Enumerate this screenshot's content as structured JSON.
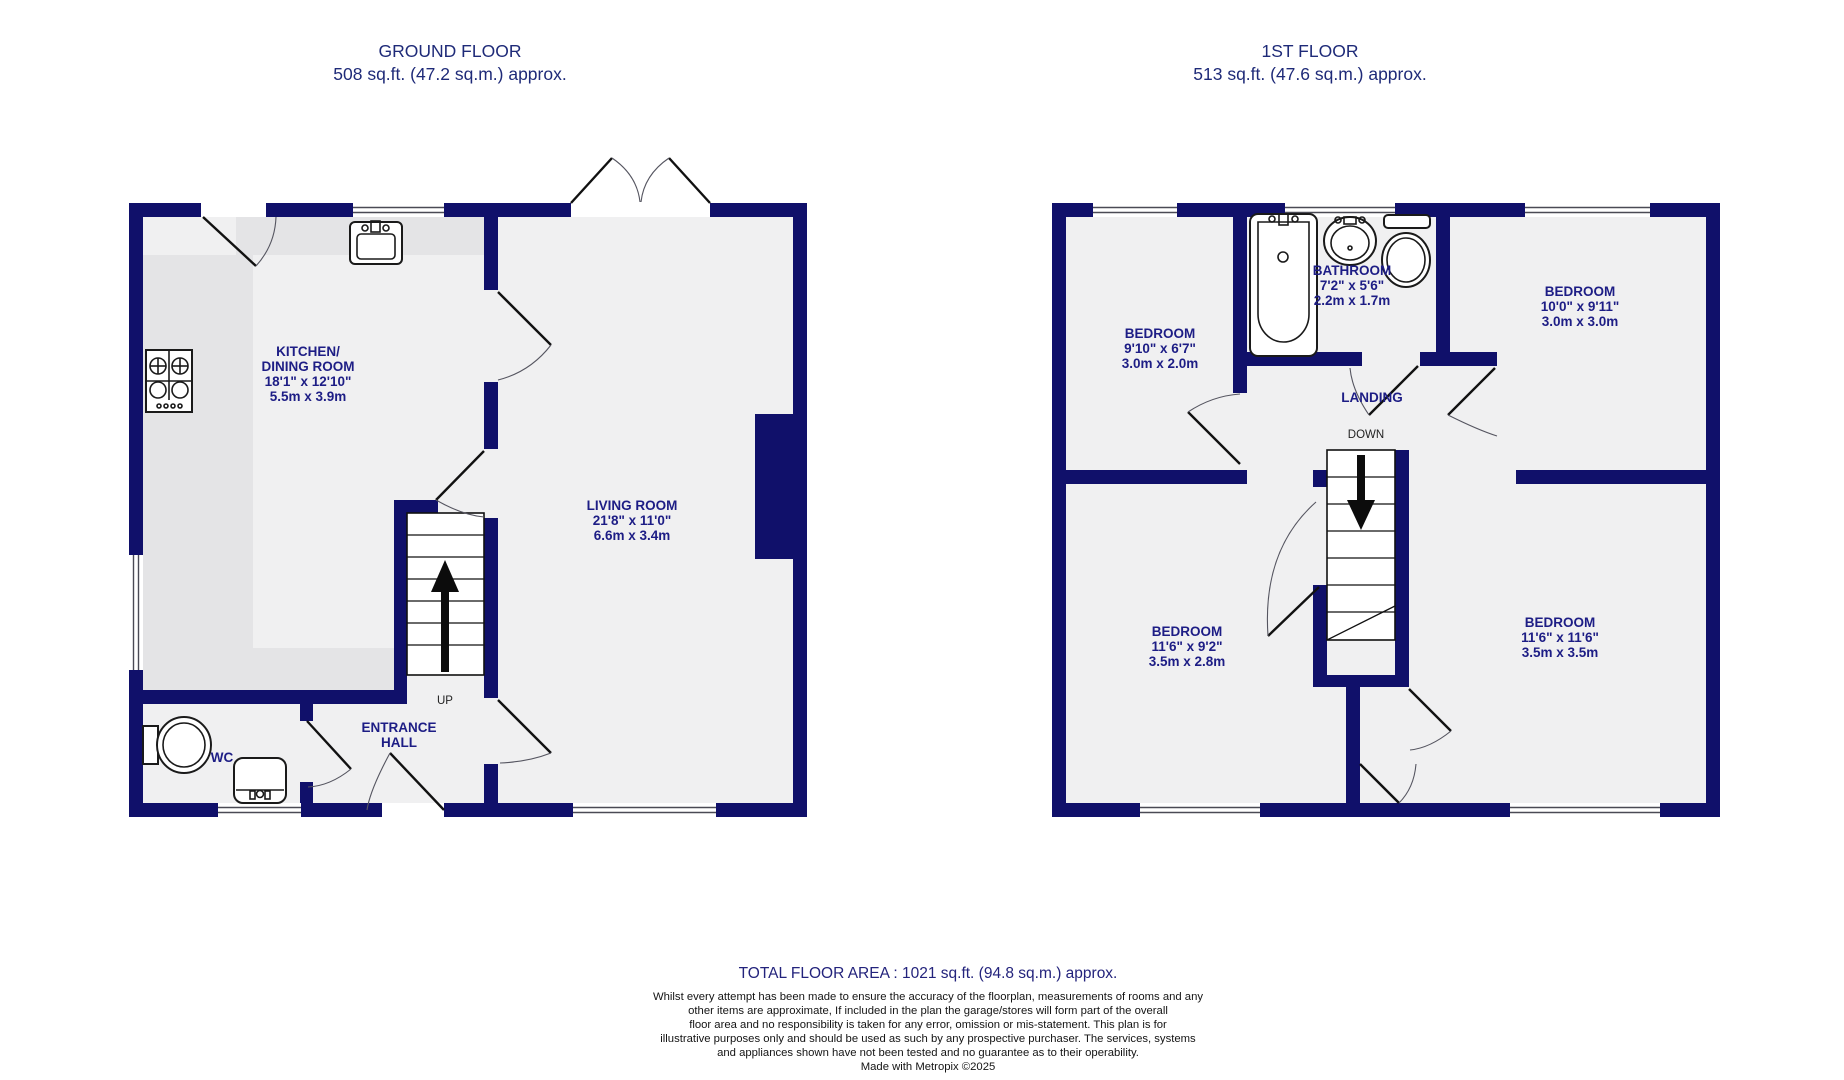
{
  "ground_floor": {
    "title": "GROUND FLOOR",
    "area": "508 sq.ft. (47.2 sq.m.) approx.",
    "kitchen": {
      "l1": "KITCHEN/",
      "l2": "DINING ROOM",
      "l3": "18'1\"  x 12'10\"",
      "l4": "5.5m  x 3.9m"
    },
    "living": {
      "l1": "LIVING ROOM",
      "l2": "21'8\"  x 11'0\"",
      "l3": "6.6m  x 3.4m"
    },
    "hall": {
      "l1": "ENTRANCE",
      "l2": "HALL"
    },
    "wc_label": "WC",
    "up_label": "UP"
  },
  "first_floor": {
    "title": "1ST FLOOR",
    "area": "513 sq.ft. (47.6 sq.m.) approx.",
    "bathroom": {
      "l1": "BATHROOM",
      "l2": "7'2\"  x 5'6\"",
      "l3": "2.2m  x 1.7m"
    },
    "bedroom_top_left": {
      "l1": "BEDROOM",
      "l2": "9'10\"  x 6'7\"",
      "l3": "3.0m  x 2.0m"
    },
    "bedroom_top_right": {
      "l1": "BEDROOM",
      "l2": "10'0\"  x 9'11\"",
      "l3": "3.0m  x 3.0m"
    },
    "bedroom_bottom_left": {
      "l1": "BEDROOM",
      "l2": "11'6\"  x 9'2\"",
      "l3": "3.5m  x 2.8m"
    },
    "bedroom_bottom_right": {
      "l1": "BEDROOM",
      "l2": "11'6\"  x 11'6\"",
      "l3": "3.5m  x 3.5m"
    },
    "landing_label": "LANDING",
    "down_label": "DOWN"
  },
  "footer": {
    "total": "TOTAL FLOOR AREA : 1021 sq.ft. (94.8 sq.m.) approx.",
    "d1": "Whilst every attempt has been made to ensure the accuracy of the floorplan, measurements of rooms and any",
    "d2": "other items are approximate, If included in the plan the garage/stores will form part of the overall",
    "d3": "floor area and no responsibility is taken for any error, omission or mis-statement. This plan is for",
    "d4": "illustrative purposes only and should be used as such by any prospective purchaser. The services, systems",
    "d5": "and appliances shown have not been tested and no guarantee as to their operability.",
    "d6": "Made with Metropix ©2025"
  },
  "colors": {
    "wall": "#10106a",
    "room_label": "#1d1d85",
    "floor_fill": "#f0f0f1",
    "counter_fill": "#e4e4e6",
    "title_text": "#1e2a78"
  }
}
